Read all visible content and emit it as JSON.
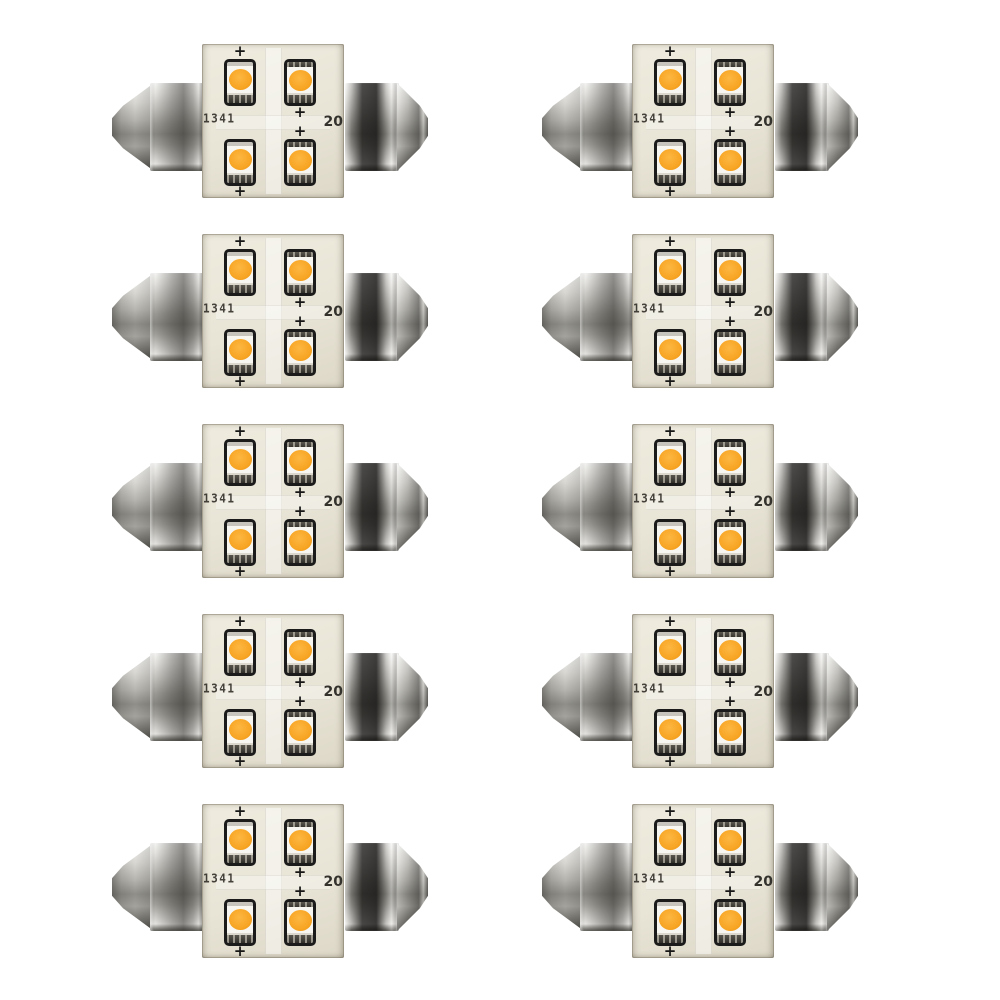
{
  "page": {
    "background_color": "#ffffff"
  },
  "grid": {
    "rows": 5,
    "columns": 2,
    "bulb_count": 10
  },
  "bulb": {
    "pcb_code_left": "1341",
    "pcb_marking_right": "20",
    "polarity_marker": "+",
    "leds_per_bulb": 4,
    "colors": {
      "led_amber": "#f6a41f",
      "pcb_board": "#e8e4d6",
      "chip_outline": "#1b1b1b",
      "metal_highlight": "#f4f4f2",
      "metal_shadow": "#4a4944",
      "background": "#ffffff"
    }
  }
}
